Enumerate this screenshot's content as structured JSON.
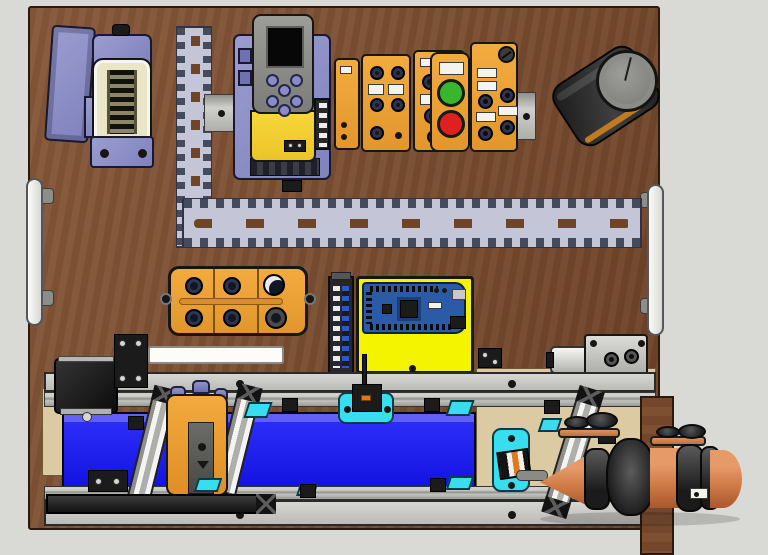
{
  "scene": {
    "type": "3d-cad-render",
    "description": "Mechatronics training board: VFD drive, fieldbus I/O modules, push buttons, Arduino controller, M12 junction box, wiring ducts, pneumatic cylinder, belt conveyor with sensors and a cone-shaped workpiece",
    "background_color": "#d9d9d5",
    "board_color": "#7b4f32"
  },
  "components": {
    "board": {
      "name": "wooden mounting board",
      "color": "#7b4f32"
    },
    "cover_panel": {
      "name": "purple cover panel",
      "color": "#9b9dd0"
    },
    "heavy_connector": {
      "name": "heavy-duty rectangular connector with pin insert",
      "color": "#8d8fc6"
    },
    "duct_vertical": {
      "name": "slotted wiring duct vertical run",
      "color": "#c4c5d6"
    },
    "duct_horizontal": {
      "name": "slotted wiring duct horizontal run",
      "color": "#c4c5d6"
    },
    "din_rail": {
      "name": "DIN rail segment",
      "color": "#b9b9b5"
    },
    "vfd": {
      "name": "variable frequency drive with keypad",
      "chassis": "#8e90c8",
      "body": "#f0cd30",
      "keypad": "#8a8a86",
      "display": "#070707"
    },
    "io_module_1": {
      "name": "fieldbus I/O module",
      "color": "#f0a83c"
    },
    "io_module_2": {
      "name": "fieldbus I/O module with M12 ports",
      "color": "#f0a83c"
    },
    "io_module_3": {
      "name": "fieldbus I/O module with M12 ports",
      "color": "#f0a83c"
    },
    "pushbutton_station": {
      "name": "push-button station",
      "green": "#39b52e",
      "red": "#e02020"
    },
    "io_module_4": {
      "name": "I/O module with M12 ports and vent screw",
      "color": "#f0a83c"
    },
    "knob_unit": {
      "name": "black cylindrical unit with rotary knob",
      "body": "#2c2c2c",
      "accent": "#c07a20"
    },
    "handle_left": {
      "name": "board carry handle left",
      "color": "#f5f5f1"
    },
    "handle_right": {
      "name": "board carry handle right",
      "color": "#f5f5f1"
    },
    "junction_box": {
      "name": "M12 distribution box with six ports",
      "color": "#f0a83c"
    },
    "terminal_strip": {
      "name": "terminal block strip",
      "color": "#26262b"
    },
    "controller_plate": {
      "name": "yellow controller mounting plate",
      "color": "#f4f400"
    },
    "controller_board": {
      "name": "Arduino Mega style microcontroller board",
      "color": "#2b5aa6"
    },
    "pneumatic_cylinder": {
      "name": "compact pneumatic cylinder with two ports",
      "color": "#c8c8c4"
    },
    "conveyor": {
      "name": "belt conveyor assembly",
      "belt": "#1414e2",
      "frame": "#c4c4c0"
    },
    "stepper_motor": {
      "name": "stepper drive motor",
      "color": "#1a1a1a"
    },
    "sorting_station": {
      "name": "orange process station with gray front panel",
      "color": "#f3a93d"
    },
    "sensor_center": {
      "name": "overhead sensor on cyan bracket",
      "color": "#161616"
    },
    "end_sensor": {
      "name": "photoelectric sensor on cyan end plate",
      "color": "#141414"
    },
    "cone_workpiece": {
      "name": "cone-nosed cylindrical workpiece",
      "color": "#d07c48"
    },
    "support_stands": {
      "name": "round support stands on plates",
      "color": "#2e2e2e"
    },
    "backdrop": {
      "name": "plywood backdrop",
      "color": "#dccaa2"
    },
    "plank": {
      "name": "vertical wooden plank",
      "color": "#7a4a2c"
    }
  }
}
